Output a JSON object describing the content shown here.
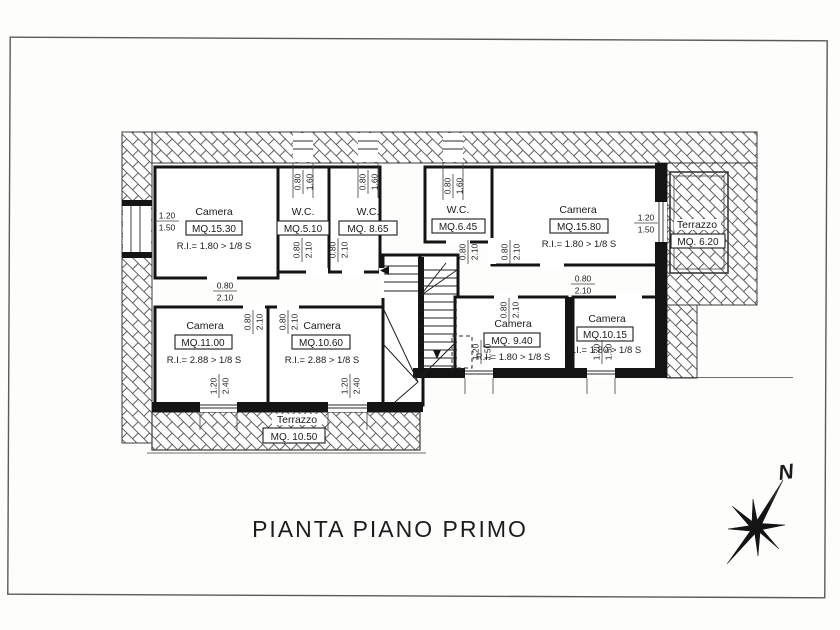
{
  "page": {
    "title": "PIANTA PIANO PRIMO",
    "compass": "N"
  },
  "rooms": [
    {
      "id": "camera-15-30",
      "name": "Camera",
      "mq": "MQ.15.30",
      "ri": "R.I.= 1.80 > 1/8 S"
    },
    {
      "id": "wc-5-10",
      "name": "W.C.",
      "mq": "MQ.5.10",
      "ri": ""
    },
    {
      "id": "wc-8-65",
      "name": "W.C.",
      "mq": "MQ. 8.65",
      "ri": ""
    },
    {
      "id": "wc-6-45",
      "name": "W.C.",
      "mq": "MQ.6.45",
      "ri": ""
    },
    {
      "id": "camera-15-80",
      "name": "Camera",
      "mq": "MQ.15.80",
      "ri": "R.I.= 1.80 > 1/8 S"
    },
    {
      "id": "terrazzo-6-20",
      "name": "Terrazzo",
      "mq": "MQ. 6.20",
      "ri": ""
    },
    {
      "id": "camera-11-00",
      "name": "Camera",
      "mq": "MQ.11.00",
      "ri": "R.I.= 2.88 > 1/8 S"
    },
    {
      "id": "camera-10-60",
      "name": "Camera",
      "mq": "MQ.10.60",
      "ri": "R.I.= 2.88 > 1/8 S"
    },
    {
      "id": "camera-9-40",
      "name": "Camera",
      "mq": "MQ. 9.40",
      "ri": "R.I.= 1.80 > 1/8 S"
    },
    {
      "id": "camera-10-15",
      "name": "Camera",
      "mq": "MQ.10.15",
      "ri": "R.I.= 1.80 > 1/8 S"
    },
    {
      "id": "terrazzo-10-50",
      "name": "Terrazzo",
      "mq": "MQ. 10.50",
      "ri": ""
    }
  ],
  "dimensions": [
    {
      "id": "d1",
      "a": "1.20",
      "b": "1.50"
    },
    {
      "id": "d2",
      "a": "0.80",
      "b": "1.60"
    },
    {
      "id": "d3",
      "a": "0.80",
      "b": "1.60"
    },
    {
      "id": "d4",
      "a": "0.80",
      "b": "1.60"
    },
    {
      "id": "d5",
      "a": "0.80",
      "b": "2.10"
    },
    {
      "id": "d6",
      "a": "0.80",
      "b": "2.10"
    },
    {
      "id": "d7",
      "a": "0.80",
      "b": "2.10"
    },
    {
      "id": "d8",
      "a": "0.80",
      "b": "2.10"
    },
    {
      "id": "d9",
      "a": "0.80",
      "b": "2.10"
    },
    {
      "id": "d10",
      "a": "0.80",
      "b": "2.10"
    },
    {
      "id": "d11",
      "a": "1.20",
      "b": "1.50"
    },
    {
      "id": "d12",
      "a": "0.80",
      "b": "2.10"
    },
    {
      "id": "d13",
      "a": "0.80",
      "b": "2.10"
    },
    {
      "id": "d14",
      "a": "1.20",
      "b": "2.40"
    },
    {
      "id": "d15",
      "a": "1.20",
      "b": "2.40"
    },
    {
      "id": "d16",
      "a": "0.80",
      "b": "2.10"
    },
    {
      "id": "d17",
      "a": "1.20",
      "b": "1.50"
    },
    {
      "id": "d18",
      "a": "1.20",
      "b": "1.50"
    }
  ]
}
